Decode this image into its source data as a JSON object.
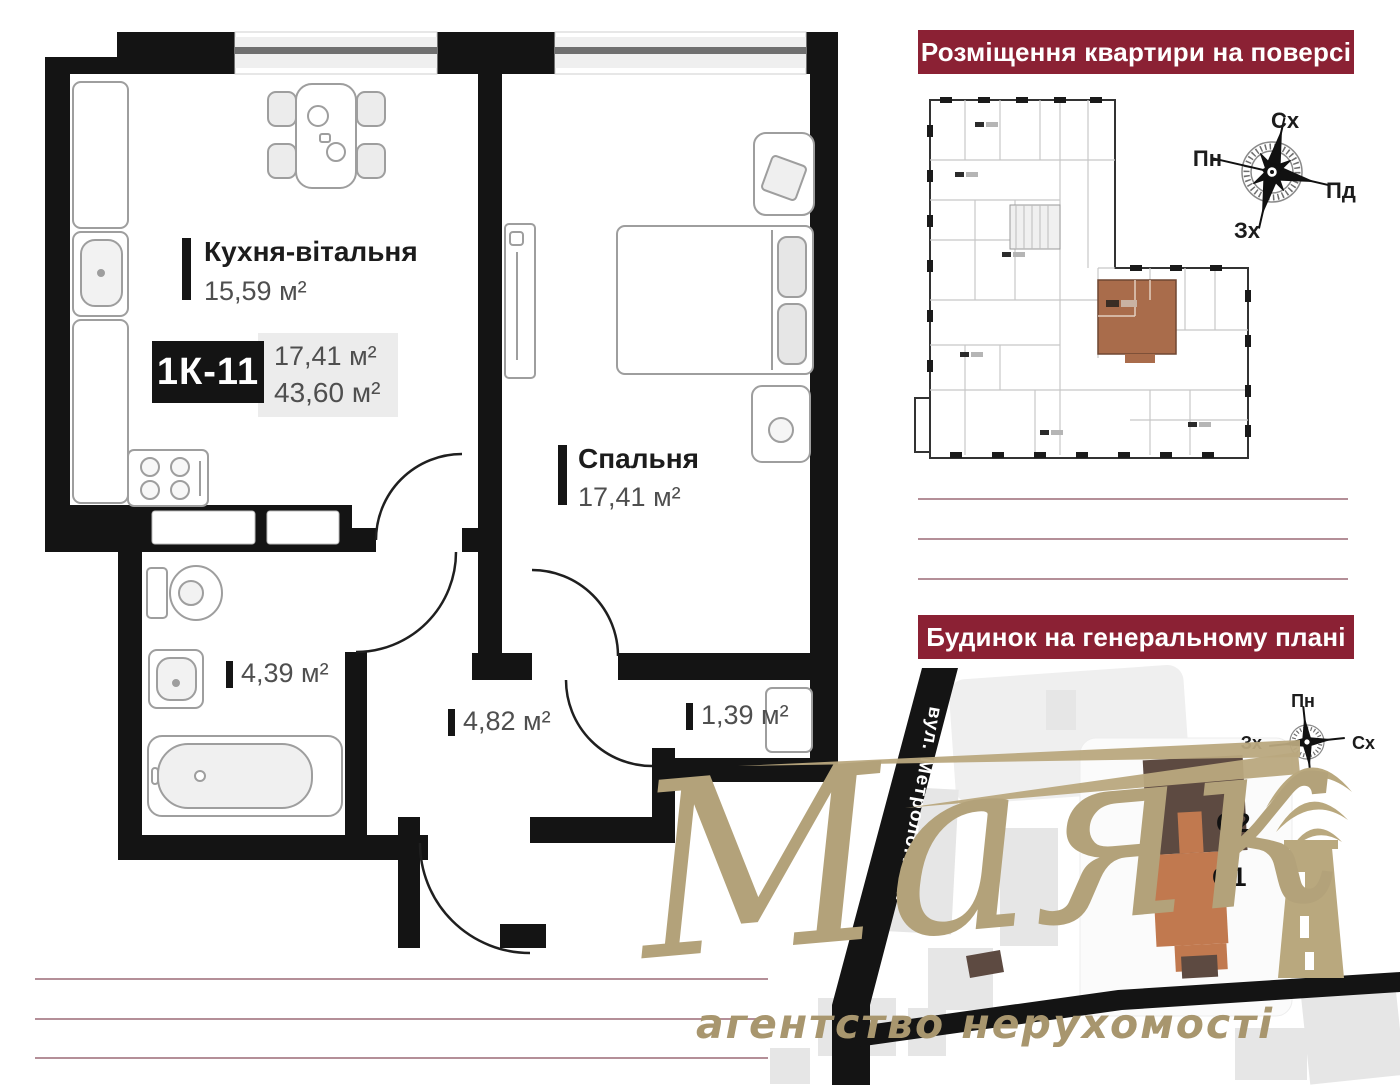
{
  "plan": {
    "kitchen": {
      "name": "Кухня-вітальня",
      "area": "15,59 м²"
    },
    "bedroom": {
      "name": "Спальня",
      "area": "17,41 м²"
    },
    "bathroom_area": "4,39 м²",
    "hall_area": "4,82 м²",
    "closet_area": "1,39 м²",
    "unit_code": "1К-11",
    "unit_living_area": "17,41 м²",
    "unit_total_area": "43,60 м²"
  },
  "floor_overview": {
    "title": "Розміщення квартири на поверсі",
    "compass": {
      "top": "Сх",
      "left": "Пн",
      "right": "Пд",
      "bottom": "Зх"
    }
  },
  "site_plan": {
    "title": "Будинок на генеральному плані",
    "compass": {
      "top": "Пн",
      "left": "Зх",
      "right": "Сх"
    },
    "street_label": "вул. Метрологічна",
    "building_labels": {
      "c2": "С2",
      "c1": "С1"
    }
  },
  "logo": {
    "brand": "Маяк",
    "tagline": "агентство нерухомості"
  },
  "colors": {
    "accent_maroon": "#8b2134",
    "logo_gold": "#b3a27a",
    "unit_highlight": "#a96c4b",
    "building_dark": "#5d4a41",
    "building_orange": "#c1794f",
    "wall_black": "#141414"
  }
}
